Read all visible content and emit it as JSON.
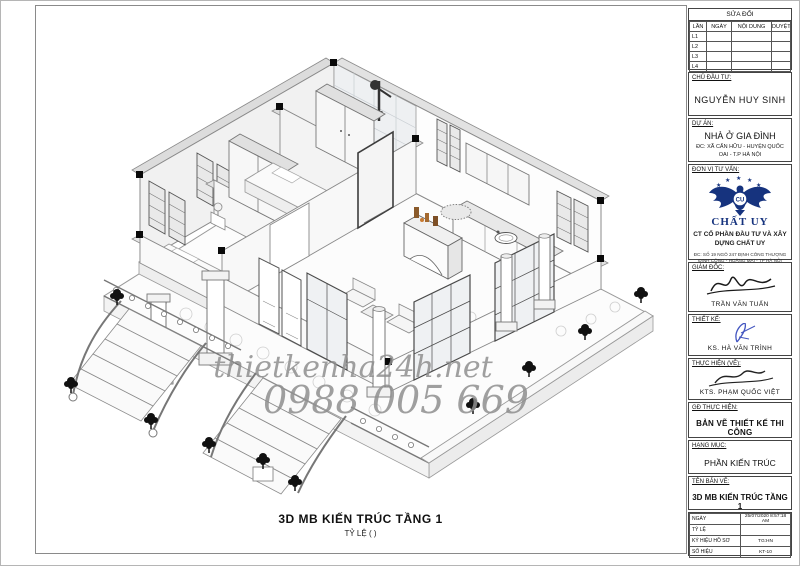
{
  "caption": {
    "title": "3D MB KIẾN TRÚC TẦNG 1",
    "scale": "TỶ LỆ ( )"
  },
  "watermark": {
    "site": "thietkenha24h.net",
    "phone": "0988 005 669"
  },
  "revision_table": {
    "title": "SỬA ĐỔI",
    "columns": [
      "LẦN",
      "NGÀY",
      "NỘI DUNG",
      "DUYỆT"
    ],
    "rows": [
      "L1",
      "L2",
      "L3",
      "L4"
    ]
  },
  "owner": {
    "label": "CHỦ ĐẦU TƯ:",
    "name": "NGUYỄN HUY SINH"
  },
  "project": {
    "label": "DỰ ÁN:",
    "name": "NHÀ Ở GIA ĐÌNH",
    "address": "ĐC: XÃ CẤN HỮU - HUYỆN QUỐC OAI - T.P HÀ NỘI"
  },
  "consultant": {
    "label": "ĐƠN VỊ TƯ VẤN:",
    "logo_monogram": "CU",
    "brand": "CHẤT UY",
    "company": "CT CỔ PHẦN ĐẦU TƯ VÀ XÂY DỰNG CHẤT UY",
    "address": "ĐC: SỐ 19 NGÕ 247 ĐỊNH CÔNG THƯỢNG ĐỊNH CÔNG - HOÀNG MAI - TP HÀ NỘI"
  },
  "director": {
    "label": "GIÁM ĐỐC:",
    "name": "TRẦN VĂN TUẤN"
  },
  "designer": {
    "label": "THIẾT KẾ:",
    "name": "KS. HÀ VĂN TRÌNH"
  },
  "drafter": {
    "label": "THỰC HIỆN (VẼ):",
    "name": "KTS. PHẠM QUỐC VIỆT"
  },
  "stage": {
    "label": "GĐ THỰC HIỆN:",
    "value": "BẢN VẼ THIẾT KẾ THI CÔNG"
  },
  "category": {
    "label": "HẠNG MỤC:",
    "value": "PHẦN KIẾN TRÚC"
  },
  "drawing_name": {
    "label": "TÊN BẢN VẼ:",
    "value": "3D MB KIẾN TRÚC TẦNG 1"
  },
  "info_table": {
    "rows": [
      {
        "label": "NGÀY",
        "value": "25/07/2020 8:57:18 AM"
      },
      {
        "label": "TỶ LỆ",
        "value": ""
      },
      {
        "label": "KÝ HIỆU HỒ SƠ",
        "value": "TG:HN"
      },
      {
        "label": "SỐ HIỆU",
        "value": "KT-10"
      }
    ]
  },
  "colors": {
    "logo_navy": "#16337e",
    "watermark_gray": "#8f8f8f"
  }
}
